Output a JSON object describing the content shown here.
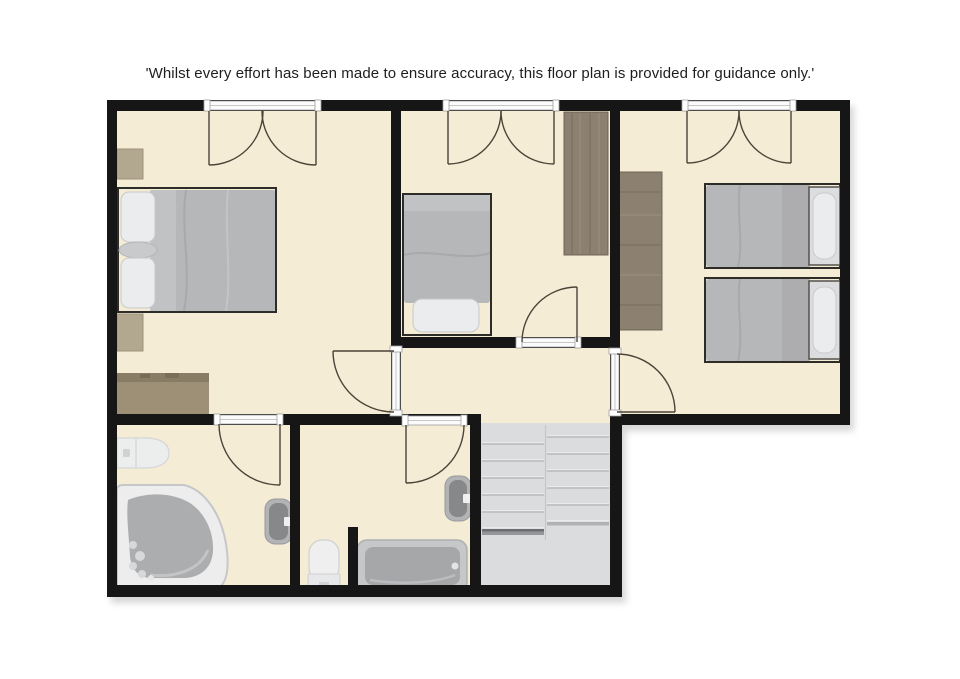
{
  "disclaimer": "'Whilst every effort has been made to ensure accuracy, this floor plan is provided for guidance only.'",
  "palette": {
    "page_bg": "#ffffff",
    "text": "#1e1e1e",
    "floor": "#f5ecd5",
    "wall": "#161616",
    "threshold": "#fbfbfb",
    "door_arc": "#4d4338",
    "stairs": "#dbdcdd",
    "wood": "#8c8170",
    "rug": "#9d9077",
    "duvet": "#b6b7b9",
    "pillow": "#ebecee",
    "fixture_light": "#efeff0",
    "fixture_dark": "#87888a",
    "frame": "#2e2c29"
  },
  "plan": {
    "rooms": [
      {
        "name": "bedroom-top-left",
        "fixtures": [
          "double-bed",
          "nightstand",
          "nightstand",
          "rug"
        ]
      },
      {
        "name": "bedroom-top-middle",
        "fixtures": [
          "single-bed",
          "wardrobe"
        ]
      },
      {
        "name": "bedroom-top-right",
        "fixtures": [
          "twin-bed",
          "twin-bed",
          "wardrobe"
        ]
      },
      {
        "name": "bathroom-left",
        "fixtures": [
          "corner-bath",
          "vanity-basin",
          "wall-basin"
        ]
      },
      {
        "name": "bathroom-middle",
        "fixtures": [
          "bathtub",
          "toilet",
          "wall-basin"
        ]
      },
      {
        "name": "landing",
        "fixtures": []
      },
      {
        "name": "staircase",
        "fixtures": [
          "double-flight-stairs"
        ]
      }
    ],
    "openings": {
      "french_double_doors": 3,
      "single_swing_doors": 5
    }
  }
}
